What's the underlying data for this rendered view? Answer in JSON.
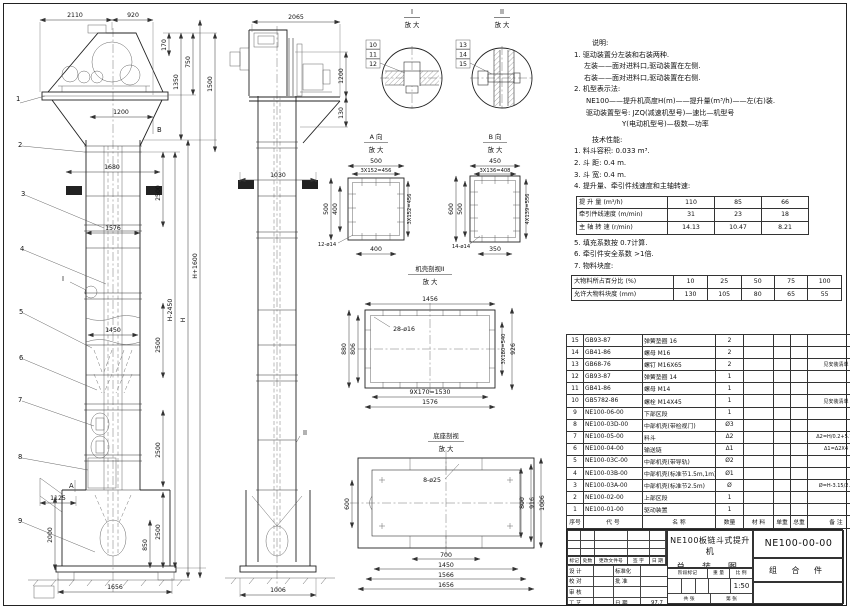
{
  "balloons": {
    "n1": "1",
    "n2": "2",
    "n3": "3",
    "n4": "4",
    "n5": "5",
    "n6": "6",
    "n7": "7",
    "n8": "8",
    "n9": "9",
    "n10": "10",
    "n11": "11",
    "n12": "12",
    "n13": "13",
    "n14": "14",
    "n15": "15"
  },
  "labels": {
    "mag": "放 大",
    "viewA": "A 向",
    "viewB": "B 向",
    "detailI": "I",
    "detailII": "II",
    "shell": "机壳剖视II",
    "base": "底座剖视",
    "markA": "A",
    "markB": "B",
    "markI": "I",
    "markII": "II"
  },
  "dims": {
    "d2110": "2110",
    "d920": "920",
    "d170": "170",
    "d750": "750",
    "d1350": "1350",
    "d1500": "1500",
    "d1200": "1200",
    "d1680": "1680",
    "d2500": "2500",
    "d1576": "1576",
    "d1450": "1450",
    "dHminus": "H-2450",
    "dH": "H",
    "dHplus": "H+1600",
    "d1125": "1125",
    "d2000": "2000",
    "d850": "850",
    "d1656": "1656",
    "d2065": "2065",
    "d130": "130",
    "d1030": "1030",
    "d1006": "1006",
    "d500": "500",
    "d3x152": "3X152=456",
    "d400": "400",
    "d12o14": "12-ø14",
    "d450": "450",
    "d3x136": "3X136=408",
    "d600": "600",
    "d4x139": "4X139=556",
    "d350": "350",
    "d14o14": "14-ø14",
    "d1456": "1456",
    "d28o16": "28-ø16",
    "d880": "880",
    "d806": "806",
    "d3x180": "3X180=540",
    "d926": "926",
    "d9x170": "9X170=1530",
    "d8o25": "8-ø25",
    "d800": "800",
    "d916": "916",
    "d700": "700",
    "d1566": "1566"
  },
  "notes": {
    "heading": "说明:",
    "lines": [
      "1. 驱动装置分左装和右装两种.",
      "左装——面对进料口,驱动装置在左侧.",
      "右装——面对进料口,驱动装置在右侧.",
      "2. 机型表示法:",
      "NE100——提升机高度H(m)——提升量(m³/h)——左(右)装.",
      "驱动装置型号: JZQ(减速机型号)—速比—机型号",
      "Y(电动机型号)—极数—功率"
    ]
  },
  "tech": {
    "heading": "技术性能:",
    "items": [
      "1. 料斗容积: 0.033 m³.",
      "2. 斗  距: 0.4 m.",
      "3. 斗  宽: 0.4 m.",
      "4. 提升量、牵引件线速度和主轴转速:"
    ],
    "items2": [
      "5. 填充系数按 0.7计算.",
      "6. 牵引件安全系数 >1倍.",
      "7. 物料块度:"
    ]
  },
  "tables": {
    "speed": {
      "rows": [
        [
          "提 升 量 (m³/h)",
          "110",
          "85",
          "66"
        ],
        [
          "牵引件线速度 (m/min)",
          "31",
          "23",
          "18"
        ],
        [
          "主 轴 转 速 (r/min)",
          "14.13",
          "10.47",
          "8.21"
        ]
      ]
    },
    "lump": {
      "rows": [
        [
          "大物料所占百分比 (%)",
          "10",
          "25",
          "50",
          "75",
          "100"
        ],
        [
          "允许大物料块度 (mm)",
          "130",
          "105",
          "80",
          "65",
          "55"
        ]
      ]
    }
  },
  "bom": {
    "headers": [
      "序号",
      "代  号",
      "名  称",
      "数量",
      "材  料",
      "单重",
      "总重",
      "备  注"
    ],
    "rows": [
      [
        "15",
        "GB93-87",
        "弹簧垫圈 16",
        "2",
        "",
        "",
        "",
        ""
      ],
      [
        "14",
        "GB41-86",
        "螺母 M16",
        "2",
        "",
        "",
        "",
        ""
      ],
      [
        "13",
        "GB68-76",
        "螺钉 M16X65",
        "2",
        "",
        "",
        "",
        "见安装清单"
      ],
      [
        "12",
        "GB93-87",
        "弹簧垫圈 14",
        "1",
        "",
        "",
        "",
        ""
      ],
      [
        "11",
        "GB41-86",
        "螺母 M14",
        "1",
        "",
        "",
        "",
        ""
      ],
      [
        "10",
        "GB5782-86",
        "螺栓 M14X45",
        "1",
        "",
        "",
        "",
        "见安装清单"
      ],
      [
        "9",
        "NE100-06-00",
        "下部区段",
        "1",
        "",
        "",
        "",
        ""
      ],
      [
        "8",
        "NE100-03D-00",
        "中部机壳(带检视门)",
        "Ø3",
        "",
        "",
        "",
        ""
      ],
      [
        "7",
        "NE100-05-00",
        "料斗",
        "Δ2",
        "",
        "",
        "",
        "Δ2=H/0.2+5.75"
      ],
      [
        "6",
        "NE100-04-00",
        "输送链",
        "Δ1",
        "",
        "",
        "",
        "Δ1=Δ2X4"
      ],
      [
        "5",
        "NE100-03C-00",
        "中部机壳(带导轨)",
        "Ø2",
        "",
        "",
        "",
        ""
      ],
      [
        "4",
        "NE100-03B-00",
        "中部机壳(标准节1.5m,1m)",
        "Ø1",
        "",
        "",
        "",
        ""
      ],
      [
        "3",
        "NE100-03A-00",
        "中部机壳(标准节2.5m)",
        "Ø",
        "",
        "",
        "",
        "Ø=H-3.15/2.5"
      ],
      [
        "2",
        "NE100-02-00",
        "上部区段",
        "1",
        "",
        "",
        "",
        ""
      ],
      [
        "1",
        "NE100-01-00",
        "驱动装置",
        "1",
        "",
        "",
        "",
        ""
      ]
    ]
  },
  "titleblock": {
    "product": "NE100板链斗式提升机",
    "title": "总 装 图",
    "number": "NE100-00-00",
    "part_type": "组 合 件",
    "rev_cols": [
      "标记",
      "处数",
      "更改文件号",
      "签 字",
      "日 期"
    ],
    "roles": [
      [
        "设 计",
        "",
        "标准化",
        ""
      ],
      [
        "校 对",
        "",
        "批 准",
        ""
      ],
      [
        "审 核",
        "",
        "",
        ""
      ],
      [
        "工 艺",
        "",
        "日 期",
        "97.7"
      ]
    ],
    "stage_label": "阶段标记",
    "weight_label": "重 量",
    "scale_label": "比 例",
    "scale": "1:50",
    "sheet_total": "共  张",
    "sheet_index": "第  张"
  }
}
